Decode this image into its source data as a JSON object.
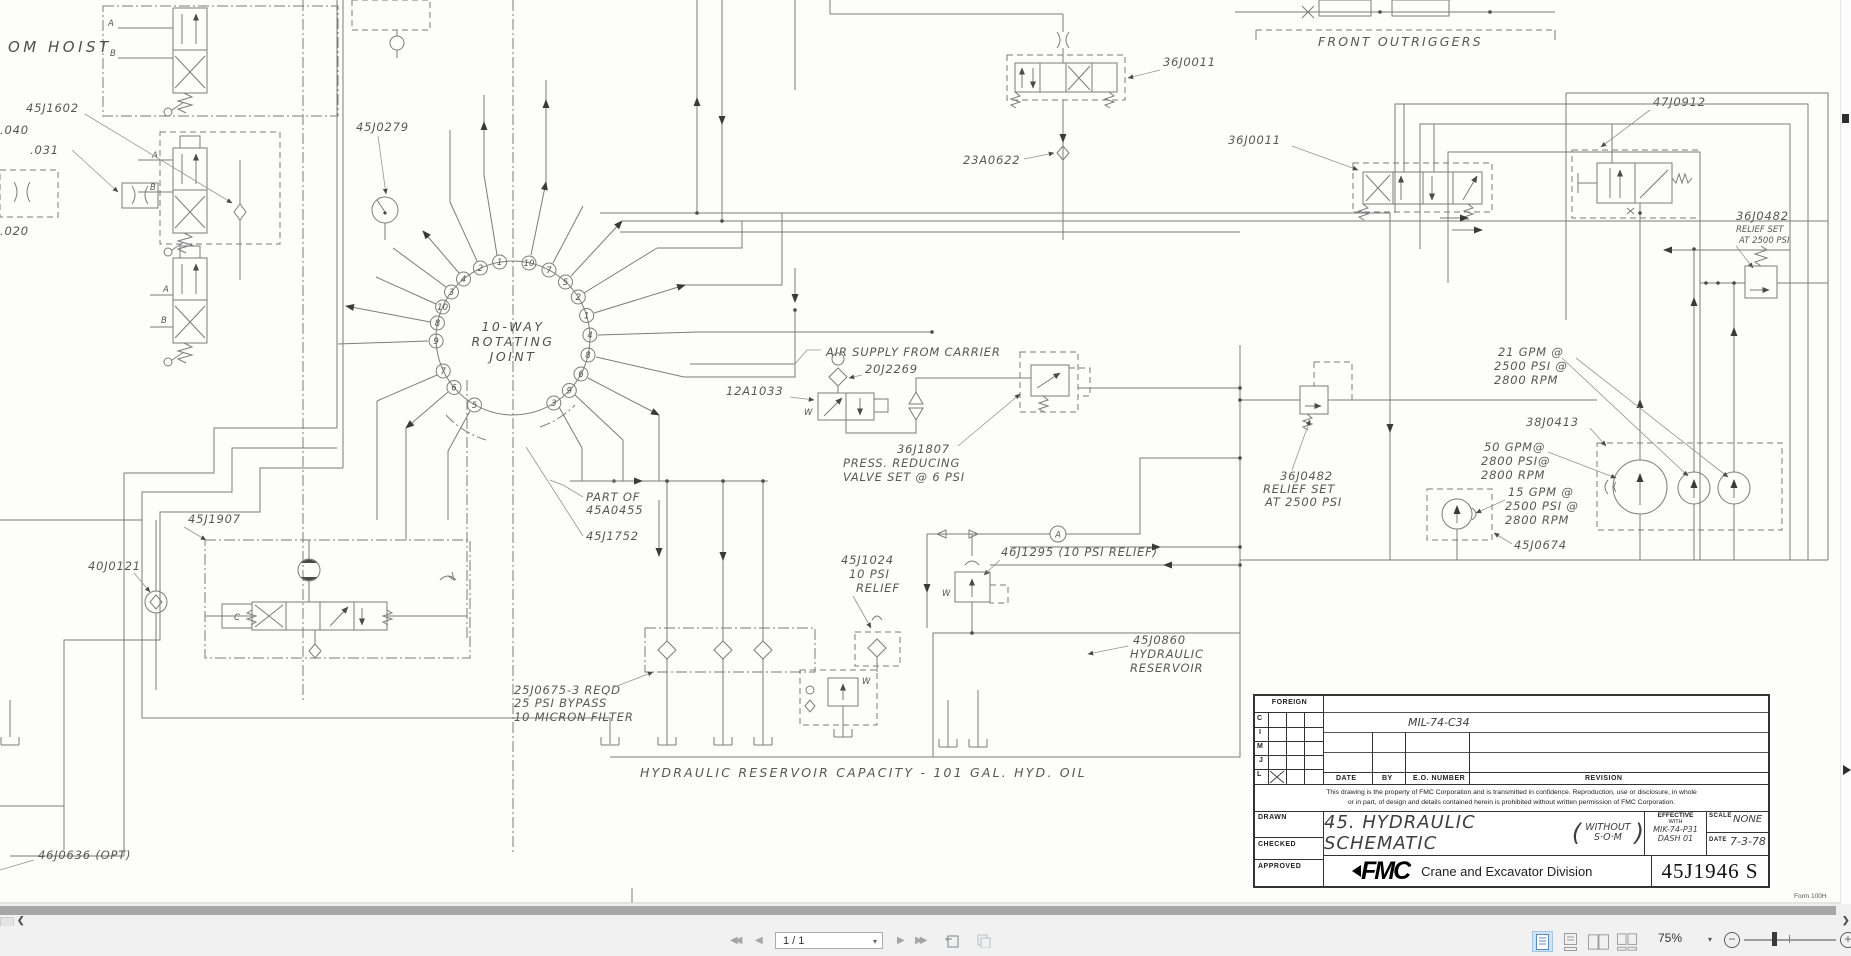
{
  "schematic": {
    "om_hoist": "OM HOIST",
    "l45j1602": "45J1602",
    "l040": ".040",
    "l031": ".031",
    "l020": ".020",
    "l45j0279": "45J0279",
    "joint1": "10-WAY",
    "joint2": "ROTATING",
    "joint3": "JOINT",
    "joint_left": [
      "1",
      "2",
      "4",
      "3",
      "10",
      "8",
      "9",
      "7",
      "6",
      "5"
    ],
    "joint_right": [
      "10",
      "7",
      "5",
      "2",
      "1",
      "4",
      "8",
      "6",
      "9",
      "3"
    ],
    "front_outriggers": "FRONT  OUTRIGGERS",
    "l36j0011a": "36J0011",
    "l23a0622": "23A0622",
    "l36j0011b": "36J0011",
    "l47j0912": "47J0912",
    "relief_r1": "36J0482",
    "relief_r2": "RELIEF SET",
    "relief_r3": "AT 2500 PSI",
    "air_supply": "AIR SUPPLY FROM CARRIER",
    "l20j2269": "20J2269",
    "l12a1033": "12A1033",
    "l36j1807": "36J1807",
    "l36j1807b": "PRESS. REDUCING",
    "l36j1807c": "VALVE SET @ 6 PSI",
    "gpm21a": "21 GPM @",
    "gpm21b": "2500 PSI @",
    "gpm21c": "2800 RPM",
    "l38j0413": "38J0413",
    "gpm50a": "50 GPM@",
    "gpm50b": "2800 PSI@",
    "gpm50c": "2800 RPM",
    "gpm15a": "15 GPM @",
    "gpm15b": "2500 PSI @",
    "gpm15c": "2800 RPM",
    "l45j0674": "45J0674",
    "relief_m1": "36J0482",
    "relief_m2": "RELIEF SET",
    "relief_m3": "AT 2500 PSI",
    "l45j1907": "45J1907",
    "l40j0121": "40J0121",
    "partof1": "PART OF",
    "partof2": "45A0455",
    "l45j1752": "45J1752",
    "l45j1024a": "45J1024",
    "l45j1024b": "10 PSI",
    "l45j1024c": "RELIEF",
    "l46j1295": "46J1295 (10 PSI RELIEF)",
    "conn_a": "A",
    "l45j0860a": "45J0860",
    "l45j0860b": "HYDRAULIC",
    "l45j0860c": "RESERVOIR",
    "lfilter1": "25J0675-3 REQD",
    "lfilter2": "25 PSI BYPASS",
    "lfilter3": "10 MICRON FILTER",
    "capacity": "HYDRAULIC  RESERVOIR  CAPACITY - 101 GAL.  HYD.  OIL",
    "l46j0636": "46J0636 (OPT)",
    "pa": "A",
    "pb": "B",
    "pc": "C",
    "pw": "W"
  },
  "title_block": {
    "foreign": "FOREIGN",
    "r1": "C",
    "r2": "I",
    "r3": "M",
    "r4": "J",
    "r5": "L",
    "eo_value": "MIL-74-C34",
    "date_label": "DATE",
    "by_label": "BY",
    "eo_label": "E.O. NUMBER",
    "revision_label": "REVISION",
    "notice1": "This drawing is the property of FMC Corporation and is transmitted in confidence. Reproduction, use or disclosure, in whole",
    "notice2": "or in part, of design and details contained herein is prohibited without written permission of FMC Corporation.",
    "drawn": "DRAWN",
    "checked": "CHECKED",
    "approved": "APPROVED",
    "title_main": "45. HYDRAULIC SCHEMATIC",
    "title_paren1": "WITHOUT",
    "title_paren2": "S·O·M",
    "effective": "EFFECTIVE",
    "with": "WITH",
    "effective_v1": "MIK-74-P31",
    "effective_v2": "DASH 01",
    "scale_label": "SCALE",
    "scale_value": "NONE",
    "date2_label": "DATE",
    "date_value": "7-3-78",
    "logo": "FMC",
    "division": "Crane and Excavator Division",
    "number": "45J1946 S",
    "form": "Form 100H"
  },
  "toolbar": {
    "page": "1 / 1",
    "zoom": "75%"
  }
}
